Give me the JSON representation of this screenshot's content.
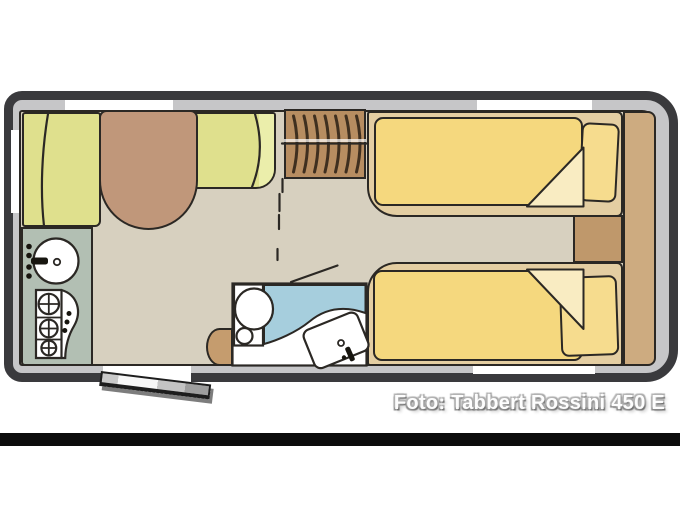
{
  "caption": {
    "text": "Foto: Tabbert Rossini 450 E"
  },
  "palette": {
    "page-bg": "#ffffff",
    "letterbox-bar": "#0c0c0c",
    "wall-border": "#3a3a3d",
    "wall-fill": "#c6c6c8",
    "window-white": "#ffffff",
    "floor": "#d7d0bf",
    "outline": "#2b2824",
    "cushion": "#dfe08d",
    "cushion-light": "#ebeeab",
    "table-brown": "#c0977a",
    "tambour-brown": "#b78d61",
    "tambour-stripe": "#3f2f1f",
    "kitchen-counter": "#b2bfb3",
    "fixture-white": "#ffffff",
    "shower-blue": "#a6cedd",
    "seat-tan": "#c59c6e",
    "bed-base": "#e4cea2",
    "blanket": "#f5d87e",
    "blanket-fold": "#f9ecc2",
    "pillow": "#f6dc8e",
    "side-strip": "#cdab80",
    "chest-brown": "#bf986b",
    "door-dark": "#1d1d1d",
    "caption-text": "#fdfdfd"
  }
}
